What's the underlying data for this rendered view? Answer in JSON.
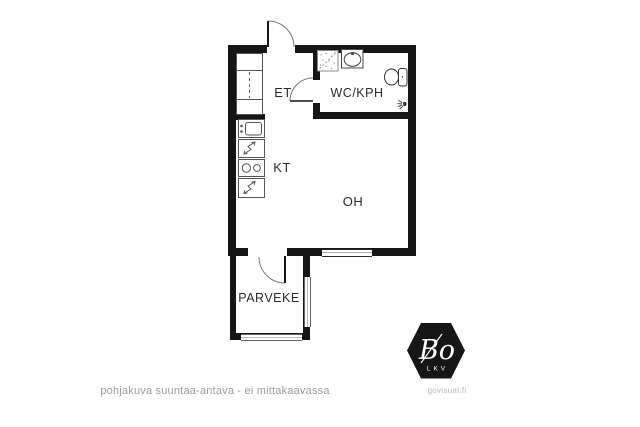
{
  "floorplan": {
    "rooms": [
      {
        "id": "et",
        "label": "ET"
      },
      {
        "id": "wc_kph",
        "label": "WC/KPH"
      },
      {
        "id": "kt",
        "label": "KT"
      },
      {
        "id": "oh",
        "label": "OH"
      },
      {
        "id": "parveke",
        "label": "PARVEKE"
      }
    ],
    "fixtures": [
      "entrance-door",
      "bathroom-door",
      "balcony-door",
      "wardrobe",
      "kitchen-sink",
      "refrigerator",
      "stove",
      "freezer",
      "washing-machine-reservation",
      "bathroom-sink",
      "toilet",
      "shower",
      "window",
      "balcony-railing"
    ],
    "caption": "pohjakuva suuntaa-antava - ei mittakaavassa",
    "colors": {
      "wall": "#161616",
      "fixture_line": "#555555",
      "label_text": "#2b2b2b",
      "caption_text": "#9c9c9c",
      "watermark_text": "#b8b8b8",
      "logo_background": "#161616",
      "logo_text": "#ffffff"
    }
  },
  "branding": {
    "logo_main": "Bo",
    "logo_sub": "LKV",
    "watermark": "govisual.fi"
  }
}
